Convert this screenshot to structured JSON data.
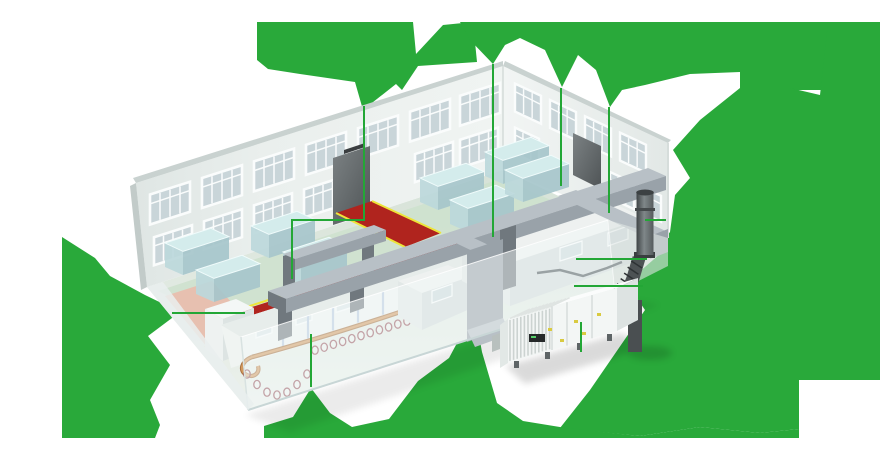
{
  "illustration": {
    "type": "isometric-cutaway-diagram",
    "subject": "industrial building ventilation system"
  },
  "colors": {
    "background": "#ffffff",
    "green": "#29a93a",
    "callout": "#23a736",
    "wall": "#e9eeec",
    "wall_shade": "#dde4e2",
    "coping": "#c9d2d0",
    "glass": "#c9d5d9",
    "frame": "#fafcfc",
    "door": "#6b7173",
    "floor": "#dce7dd",
    "work_floor": "#cfe1cf",
    "red": "#b0241e",
    "yellow": "#ede539",
    "pink": "#e7c0b0",
    "table_top": "#d4ecec",
    "table_front": "#bcd8db",
    "table_side": "#a6c6cb",
    "duct": "#b8c0c6",
    "duct_shade": "#99a2a9",
    "duct_dark": "#70787e",
    "room": "#eef1f0",
    "ahu_body": "#f3f6f5",
    "ahu_rib": "#ccd3d1",
    "ahu_seam": "#d5dbd9",
    "ahu_display": "#26292a",
    "ahu_label": "#d9ca41",
    "stack_dark": "#4d5254",
    "conveyor_rail": "#d39a5f",
    "conveyor_rail_edge": "#a8713f",
    "conveyor_ring": "#9a575f",
    "hanger": "#b9c9de"
  },
  "callouts": [
    {
      "id": "entrance-door-zone",
      "points": [
        [
          364,
          106
        ],
        [
          364,
          221
        ]
      ]
    },
    {
      "id": "duct-portal",
      "points": [
        [
          364,
          220
        ],
        [
          292,
          220
        ],
        [
          292,
          279
        ]
      ]
    },
    {
      "id": "main-duct-run",
      "points": [
        [
          493,
          64
        ],
        [
          493,
          237
        ]
      ]
    },
    {
      "id": "production-room-roof",
      "points": [
        [
          561,
          88
        ],
        [
          561,
          186
        ]
      ]
    },
    {
      "id": "cleanroom-roof",
      "points": [
        [
          609,
          107
        ],
        [
          609,
          213
        ]
      ]
    },
    {
      "id": "exhaust-stack",
      "points": [
        [
          645,
          220
        ],
        [
          666,
          220
        ]
      ]
    },
    {
      "id": "stack-flex-duct",
      "points": [
        [
          576,
          259
        ],
        [
          647,
          259
        ]
      ]
    },
    {
      "id": "ahu-connection",
      "points": [
        [
          574,
          286
        ],
        [
          643,
          286
        ]
      ]
    },
    {
      "id": "side-room",
      "points": [
        [
          172,
          313
        ],
        [
          245,
          313
        ]
      ]
    },
    {
      "id": "conveyor-line",
      "points": [
        [
          311,
          334
        ],
        [
          311,
          387
        ]
      ]
    },
    {
      "id": "ahu-unit",
      "points": [
        [
          581,
          322
        ],
        [
          581,
          352
        ]
      ]
    }
  ],
  "windows": {
    "left_wall_upper_x": [
      150,
      202,
      254,
      306,
      358,
      410,
      460
    ],
    "left_wall_lower_x": [
      154,
      204,
      254,
      304,
      415,
      460
    ],
    "right_wall_upper_x": [
      515,
      550,
      585,
      620
    ],
    "right_wall_lower_x": [
      515,
      610,
      637
    ]
  },
  "tables": [
    [
      165,
      243
    ],
    [
      196,
      270
    ],
    [
      251,
      226
    ],
    [
      283,
      252
    ],
    [
      420,
      178
    ],
    [
      450,
      200
    ],
    [
      485,
      152
    ],
    [
      505,
      170
    ]
  ],
  "conveyor": {
    "hanger_x": [
      283,
      308,
      333,
      358,
      383,
      408,
      433
    ],
    "ring_droop_x_range": [
      247,
      307
    ],
    "ring_line_x_range": [
      315,
      453
    ]
  }
}
